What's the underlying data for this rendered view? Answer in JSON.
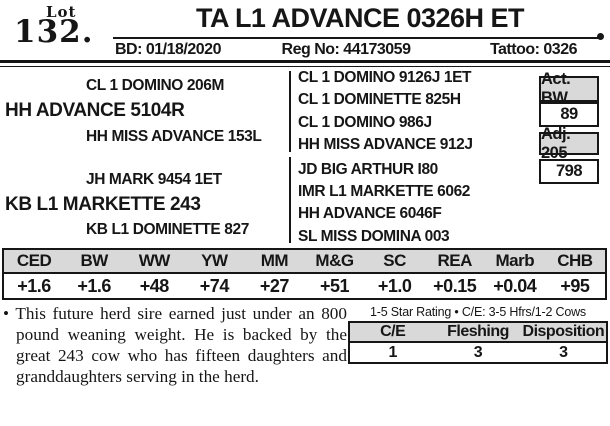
{
  "lot": {
    "label": "Lot",
    "number": "132."
  },
  "header": {
    "title": "TA L1 ADVANCE 0326H ET",
    "birth_date": "BD: 01/18/2020",
    "reg_no": "Reg No: 44173059",
    "tattoo": "Tattoo: 0326"
  },
  "pedigree": {
    "sire": "HH ADVANCE 5104R",
    "sire_sire": "CL 1 DOMINO 206M",
    "sire_dam": "HH MISS ADVANCE 153L",
    "dam": "KB L1 MARKETTE 243",
    "dam_sire": "JH MARK 9454 1ET",
    "dam_dam": "KB L1 DOMINETTE 827",
    "great_grandparents": [
      "CL 1 DOMINO 9126J 1ET",
      "CL 1 DOMINETTE 825H",
      "CL 1 DOMINO 986J",
      "HH MISS ADVANCE 912J",
      "JD BIG ARTHUR I80",
      "IMR L1 MARKETTE 6062",
      "HH ADVANCE 6046F",
      "SL MISS DOMINA 003"
    ]
  },
  "weights": {
    "act_bw_label": "Act. BW",
    "act_bw_value": "89",
    "adj_205_label": "Adj. 205",
    "adj_205_value": "798"
  },
  "epd": {
    "headers": [
      "CED",
      "BW",
      "WW",
      "YW",
      "MM",
      "M&G",
      "SC",
      "REA",
      "Marb",
      "CHB"
    ],
    "values": [
      "+1.6",
      "+1.6",
      "+48",
      "+74",
      "+27",
      "+51",
      "+1.0",
      "+0.15",
      "+0.04",
      "+95"
    ]
  },
  "footnote": {
    "bullet": "•",
    "text": "This future herd sire earned just under an 800 pound weaning weight. He is backed by the great 243 cow who has fifteen daughters and granddaughters serving in the herd."
  },
  "rating": {
    "caption": "1-5 Star Rating • C/E: 3-5 Hfrs/1-2 Cows",
    "headers": [
      "C/E",
      "Fleshing",
      "Disposition"
    ],
    "values": [
      "1",
      "3",
      "3"
    ]
  },
  "colors": {
    "table_header_gray": "#d9d9d9",
    "ink": "#161616"
  }
}
